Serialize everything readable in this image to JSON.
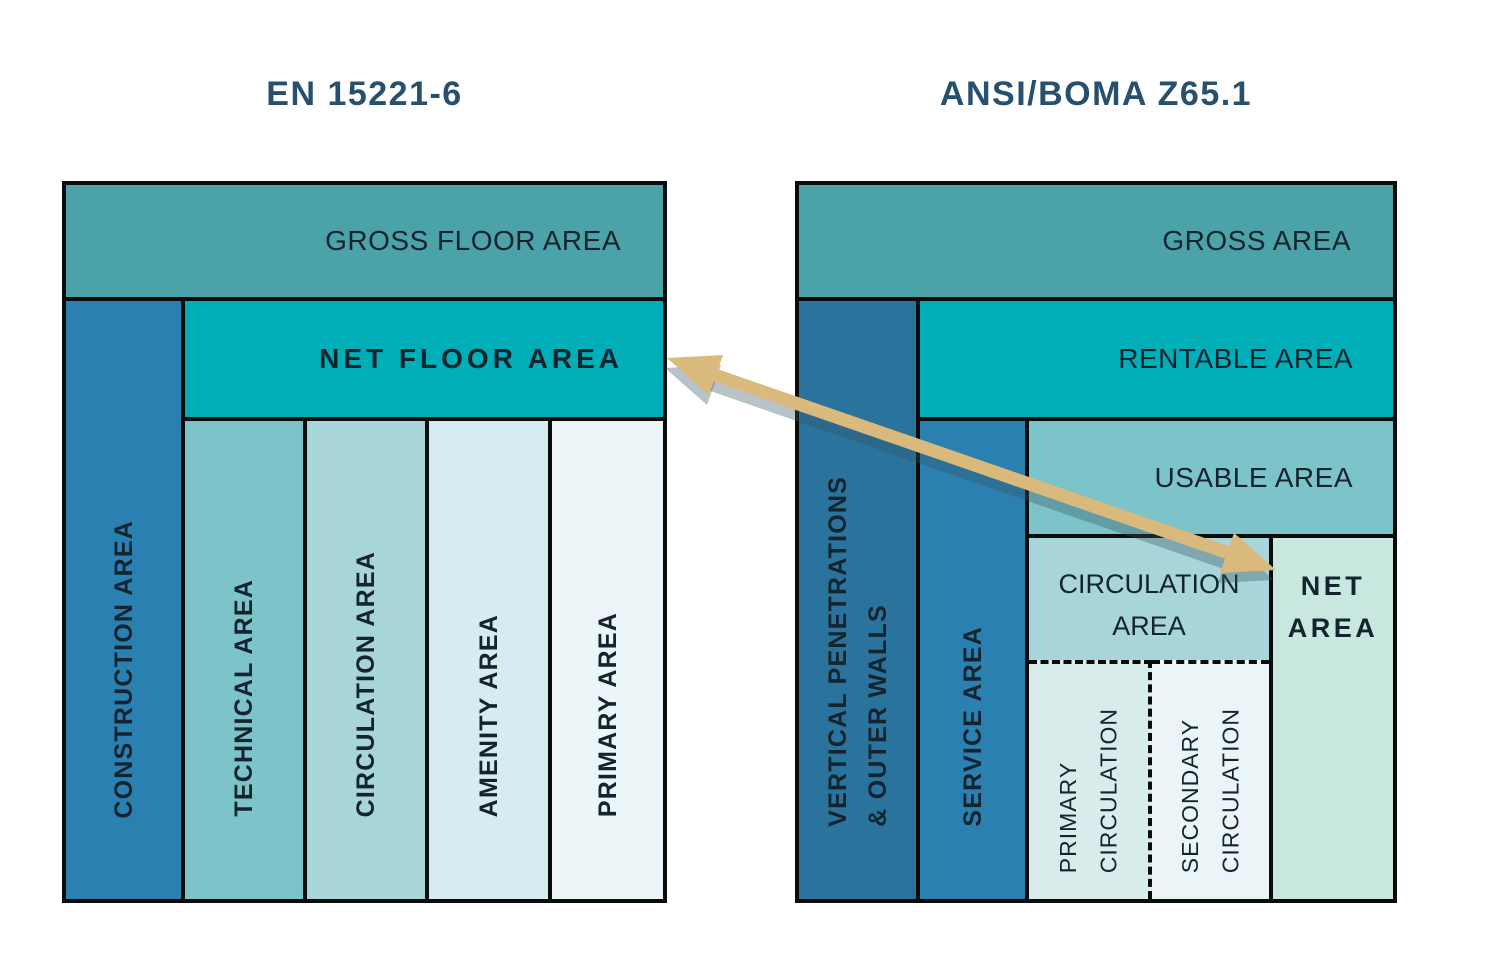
{
  "titles": {
    "left": "EN 15221-6",
    "right": "ANSI/BOMA Z65.1"
  },
  "en_diagram": {
    "gross": "GROSS FLOOR AREA",
    "construction": "CONSTRUCTION AREA",
    "net": "NET FLOOR AREA",
    "technical": "TECHNICAL AREA",
    "circulation": "CIRCULATION AREA",
    "amenity": "AMENITY AREA",
    "primary": "PRIMARY AREA"
  },
  "boma_diagram": {
    "gross": "GROSS AREA",
    "vertical_penetrations": "VERTICAL PENETRATIONS\n& OUTER WALLS",
    "rentable": "RENTABLE AREA",
    "service": "SERVICE AREA",
    "usable": "USABLE AREA",
    "circulation": "CIRCULATION\nAREA",
    "net": "NET\nAREA",
    "primary_circulation": "PRIMARY\nCIRCULATION",
    "secondary_circulation": "SECONDARY\nCIRCULATION"
  },
  "colors": {
    "background": "#ffffff",
    "border_black": "#0b0b0b",
    "title_text": "#27506e",
    "box_text": "#13242e",
    "gross_teal": "#4ba3a9",
    "bright_teal": "#00aeb8",
    "primary_blue": "#2b80b2",
    "dark_blue": "#2a739d",
    "medium_teal": "#7dc4ca",
    "light_teal": "#a8d5da",
    "pale_cyan": "#d7ecf0",
    "palest_cyan": "#ecf5f8",
    "pale_green": "#c7e7df",
    "sub_primary": "#d8eceb",
    "sub_secondary": "#ebf5f7",
    "arrow": "#dab97c",
    "arrow_shadow": "rgba(52,82,98,0.35)"
  }
}
